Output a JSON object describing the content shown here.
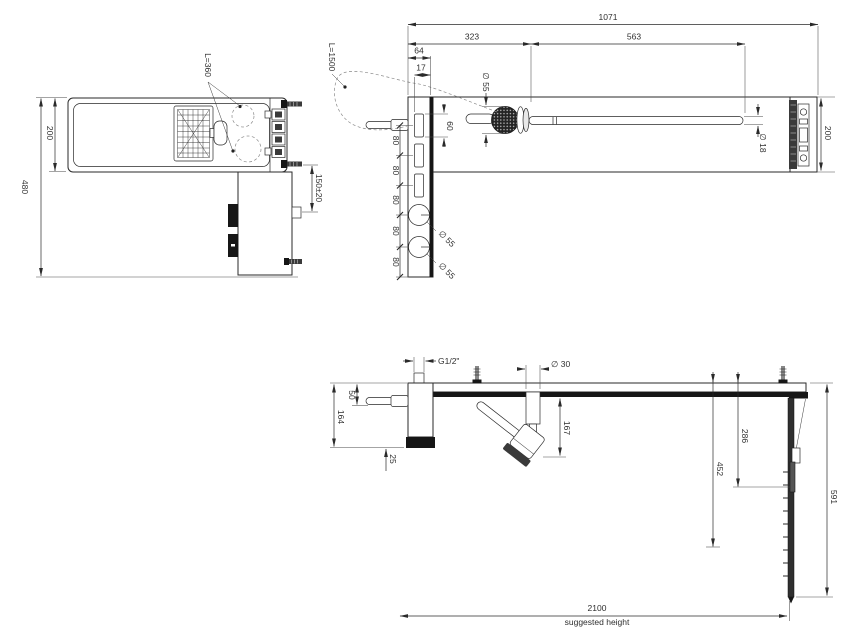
{
  "drawing": {
    "kind": "technical-installation-drawing",
    "views": {
      "plan": {
        "dim_width": "200",
        "dim_total_depth": "480",
        "hose_label": "L=360",
        "dim_outlet_offset": "150±20"
      },
      "front": {
        "dim_total_length": "1071",
        "dim_handshower_pos": "323",
        "dim_slidebar_length": "563",
        "dim_column_width": "64",
        "dim_slot_offset": "17",
        "dim_slot_length": "60",
        "dia_handshower_head": "∅ 55",
        "dia_slide_bar": "∅ 18",
        "dim_bar_width": "200",
        "hose_label": "L=1500",
        "dim_spacing": [
          "80",
          "80",
          "80",
          "80",
          "80"
        ],
        "dia_knob_upper": "∅ 55",
        "dia_knob_lower": "∅ 55"
      },
      "side": {
        "thread_label": "G1/2\"",
        "dia_dock": "∅ 30",
        "dim_handle_offset": "50",
        "dim_body_height": "164",
        "dim_spout_offset": "25",
        "dim_dock_drop": "167",
        "dim_slider_drop": "286",
        "dim_rail_mid": "452",
        "dim_rail_drop": "591",
        "dim_install_height": "2100",
        "install_note": "suggested height"
      }
    },
    "colors": {
      "line": "#2a2a2a",
      "dark_fill": "#161616",
      "background": "#ffffff"
    }
  }
}
